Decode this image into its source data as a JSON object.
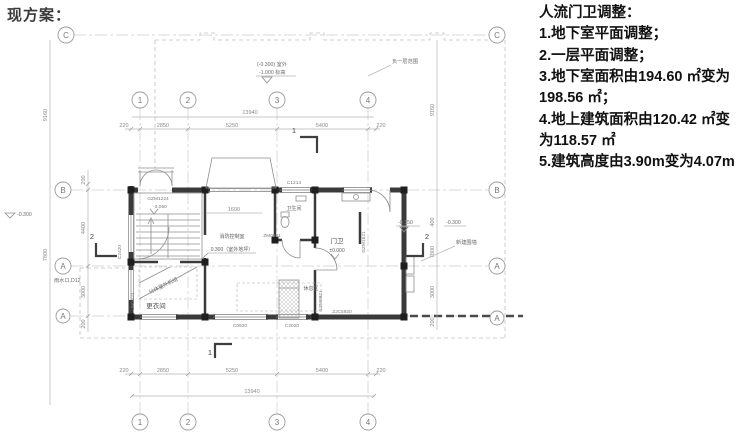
{
  "title": "现方案：",
  "notes": {
    "heading": "人流门卫调整：",
    "items": [
      "1.地下室平面调整；",
      "2.一层平面调整；",
      "3.地下室面积由194.60 ㎡变为198.56 ㎡；",
      "4.地上建筑面积由120.42 ㎡变为118.57 ㎡",
      "5.建筑高度由3.90m变为4.07m"
    ]
  },
  "plan": {
    "axis_labels": {
      "a1": "1",
      "a2": "2",
      "a3": "3",
      "a4": "4",
      "c": "C",
      "b": "B",
      "a": "A"
    },
    "dims": {
      "total_h": "13940",
      "seg220": "220",
      "seg2850": "2850",
      "seg5250": "5250",
      "seg5400": "5400",
      "left_total": "9160",
      "seg200": "200",
      "seg4400": "4400",
      "seg3000": "3000",
      "seg7800": "7800",
      "seg400": "400",
      "dim_1600": "1600"
    },
    "levels": {
      "outdoor_l1": "(-0.300) 室外",
      "outdoor_l2": "-1.000 标高",
      "minus_0300": "-0.300",
      "minus_0150": "-0.150",
      "zero": "±0.000",
      "stair": "-3.050",
      "center_l2": "0.300（室外地坪）"
    },
    "rooms": {
      "gate": "门卫",
      "bath": "卫生间",
      "rest": "休息区",
      "change": "更衣间",
      "control": "消防控制室"
    },
    "codes": {
      "gzm1224": "GZM1224",
      "c2420": "C2420",
      "jm1524": "JM1524",
      "c1214": "C1214",
      "zm0921": "ZM0921",
      "c0920": "C0920",
      "c2020": "C2020",
      "zjc5920": "ZJC5920",
      "gzm0821": "GZM0821",
      "gzm1621": "GZM1621"
    },
    "annotations": {
      "basement": "负一层范围",
      "fence": "新建围墙",
      "rain": "雨水口,D12",
      "ac": "分体室外机组"
    },
    "sections": {
      "s1": "1",
      "s2": "2"
    }
  }
}
